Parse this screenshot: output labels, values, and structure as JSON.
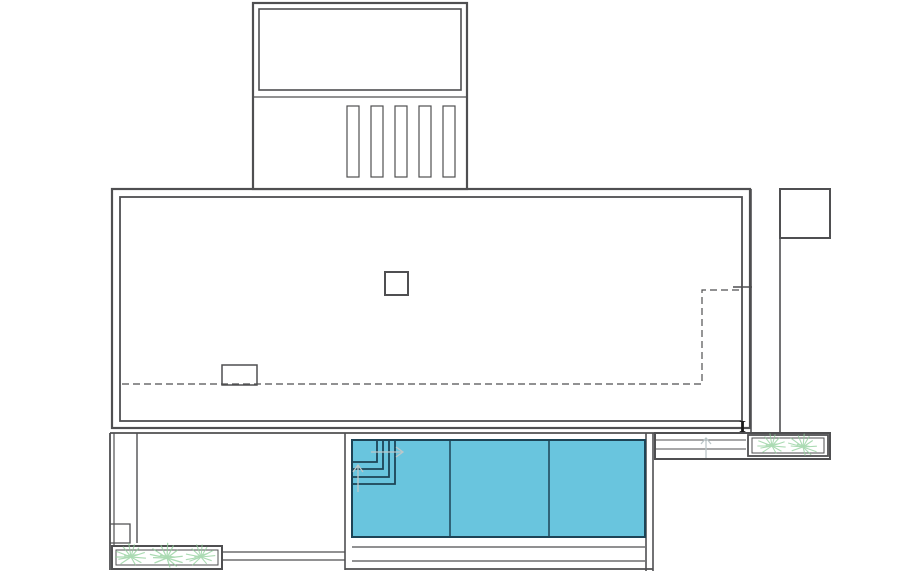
{
  "drawing": {
    "kind": "architectural-floor-plan"
  },
  "colors": {
    "background": "#ffffff",
    "line": "#4f4f51",
    "pool_fill": "#69c5de",
    "pool_edge": "#1d4456",
    "plant": "#8fcf9a",
    "faint_arrow": "#bcc7c9",
    "marker": "#1a1a1a"
  },
  "labels": {
    "section_marker": "I"
  },
  "counts": {
    "roof_louvers": 5,
    "pool_lanes": 3,
    "pool_corner_steps": 4,
    "left_planter_plants": 3,
    "right_planter_plants": 2
  }
}
